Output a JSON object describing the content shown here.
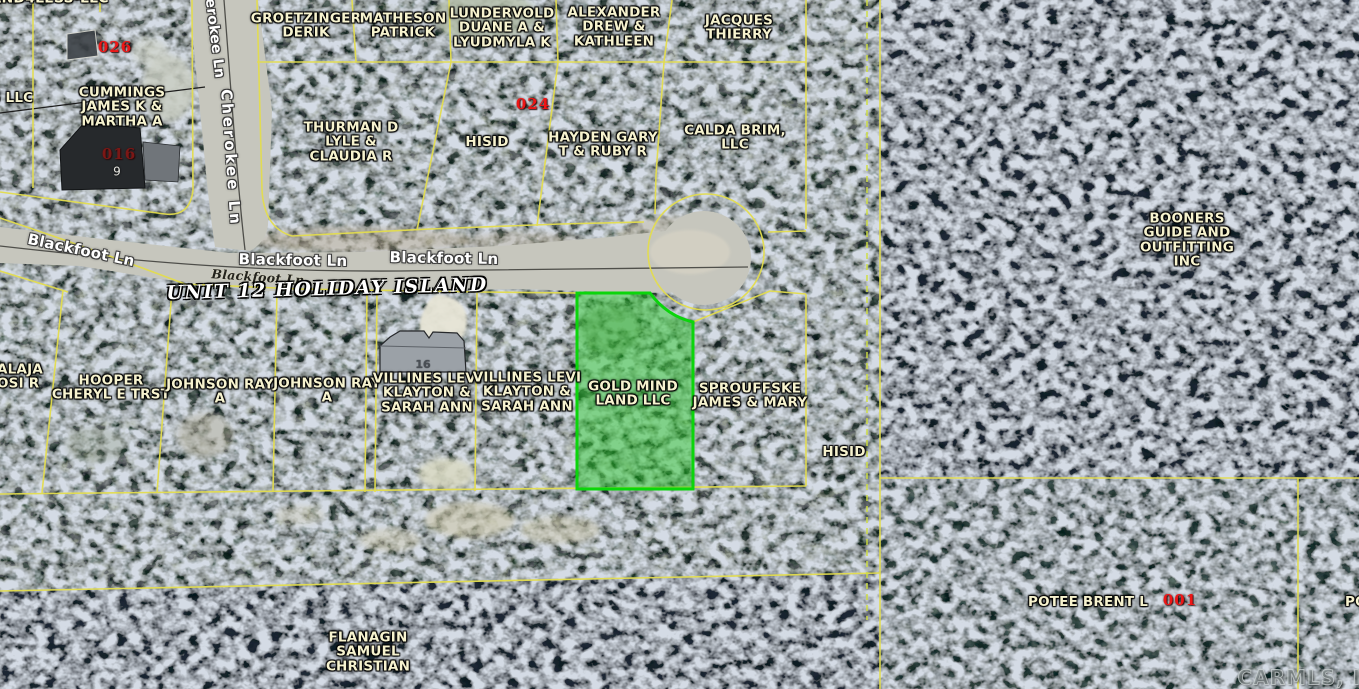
{
  "map": {
    "unit_label": "UNIT 12 HOLIDAY ISLAND",
    "watermark": "CARMLS, INC",
    "selected_parcel": "GOLD MIND LAND LLC",
    "colors": {
      "parcel_line": "#e3dd4e",
      "boundary_dashed": "#cede3f",
      "selected_fill": "#22c522",
      "selected_stroke": "#0bd50b",
      "label_text": "#f7f3cf",
      "red_number": "#ee1616",
      "road_fill": "#c6c6bd"
    }
  },
  "roads": {
    "blackfoot_label_left": "Blackfoot Ln",
    "blackfoot_label_center": "Blackfoot Ln",
    "blackfoot_label_right": "Blackfoot Ln",
    "blackfoot_label_small": "Blackfoot Ln",
    "cherokee_label_upper": "Cherokee Ln",
    "cherokee_label_lower": "Cherokee Ln"
  },
  "parcels": [
    {
      "owner": "LAND4LESS-LLC"
    },
    {
      "owner": "S LLC"
    },
    {
      "owner": "CUMMINGS\nJAMES K &\nMARTHA A"
    },
    {
      "owner": "GROETZINGER\nDERIK"
    },
    {
      "owner": "MATHESON\nPATRICK"
    },
    {
      "owner": "LUNDERVOLD\nDUANE A &\nLYUDMYLA K"
    },
    {
      "owner": "ALEXANDER\nDREW &\nKATHLEEN"
    },
    {
      "owner": "JACQUES\nTHIERRY"
    },
    {
      "owner": "THURMAN D\nLYLE &\nCLAUDIA R"
    },
    {
      "owner": "HISID"
    },
    {
      "owner": "HAYDEN GARY\nT & RUBY R"
    },
    {
      "owner": "CALDA BRIM,\nLLC"
    },
    {
      "owner": "BOONERS\nGUIDE AND\nOUTFITTING\nINC"
    },
    {
      "owner": "ALAJA\nOSI R"
    },
    {
      "owner": "HOOPER\nCHERYL E TRST"
    },
    {
      "owner": "JOHNSON RAY\nA"
    },
    {
      "owner": "JOHNSON RAY\nA"
    },
    {
      "owner": "VILLINES LEVI\nKLAYTON &\nSARAH ANN"
    },
    {
      "owner": "VILLINES LEVI\nKLAYTON &\nSARAH ANN"
    },
    {
      "owner": "GOLD MIND\nLAND LLC"
    },
    {
      "owner": "SPROUFFSKE\nJAMES & MARY"
    },
    {
      "owner": "HISID"
    },
    {
      "owner": "POTEE BRENT L"
    },
    {
      "owner": "PO"
    },
    {
      "owner": "FLANAGIN\nSAMUEL\nCHRISTIAN"
    }
  ],
  "parcel_numbers": [
    {
      "value": "026"
    },
    {
      "value": "016"
    },
    {
      "value": "024"
    },
    {
      "value": "001"
    }
  ],
  "house_numbers": [
    {
      "value": "9"
    },
    {
      "value": "16"
    }
  ]
}
